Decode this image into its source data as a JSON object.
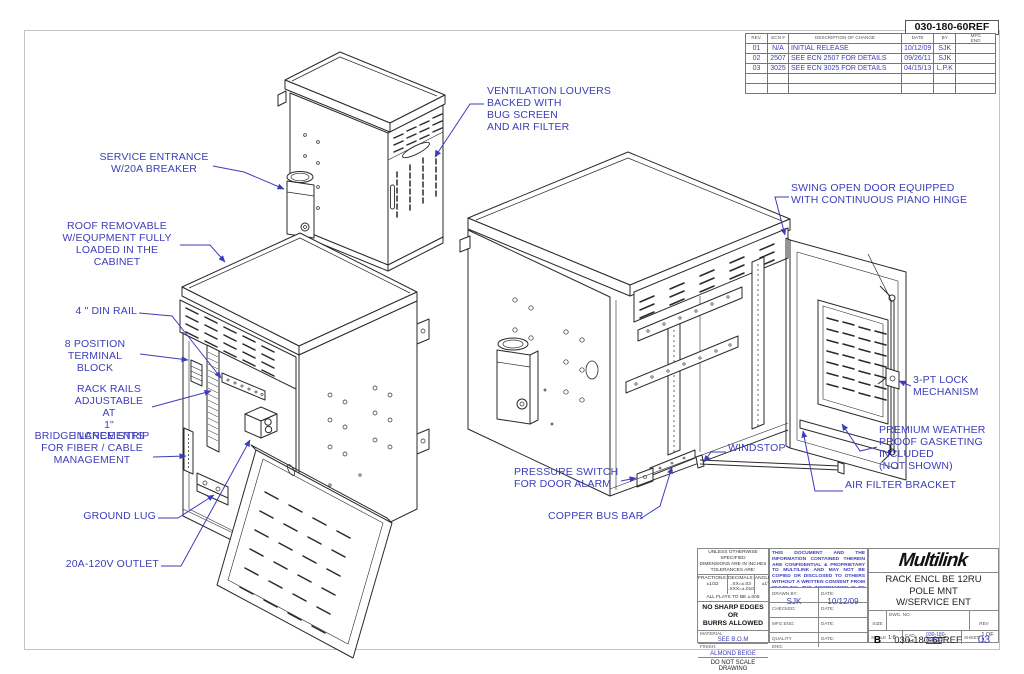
{
  "colors": {
    "callout_blue": "#3d3dba",
    "line_black": "#2a2a2a",
    "border_gray": "#c4c4c4"
  },
  "rev_table": {
    "ref": "030-180-60REF",
    "headers": {
      "rev": "REV.",
      "ecn": "ECN #",
      "desc": "DESCRIPTION OF CHANGE",
      "date": "DATE",
      "by": "BY",
      "mfg": "MFG\nENG"
    },
    "rows": [
      {
        "rev": "01",
        "ecn": "N/A",
        "desc": "INITIAL RELEASE",
        "date": "10/12/09",
        "by": "SJK",
        "mfg": ""
      },
      {
        "rev": "02",
        "ecn": "2507",
        "desc": "SEE ECN 2507 FOR DETAILS",
        "date": "09/26/11",
        "by": "SJK",
        "mfg": ""
      },
      {
        "rev": "03",
        "ecn": "3025",
        "desc": "SEE ECN 3025 FOR DETAILS",
        "date": "04/15/13",
        "by": "L.P.K",
        "mfg": ""
      },
      {
        "rev": "",
        "ecn": "",
        "desc": "",
        "date": "",
        "by": "",
        "mfg": ""
      },
      {
        "rev": "",
        "ecn": "",
        "desc": "",
        "date": "",
        "by": "",
        "mfg": ""
      }
    ]
  },
  "callouts": {
    "service_entrance": "SERVICE ENTRANCE\nW/20A BREAKER",
    "ventilation_louvers": "VENTILATION LOUVERS\nBACKED WITH\nBUG SCREEN\nAND AIR FILTER",
    "roof_removable": "ROOF REMOVABLE\nW/EQUPMENT FULLY\nLOADED IN THE CABINET",
    "din_rail": "4 \" DIN RAIL",
    "terminal_block": "8 POSITION\nTERMINAL BLOCK",
    "rack_rails": "RACK RAILS\nADJUSTABLE AT\n1\" INCREMENTS",
    "bridge_lance": "BRIDGE LANCE STRIP\nFOR FIBER / CABLE\nMANAGEMENT",
    "ground_lug": "GROUND LUG",
    "outlet": "20A-120V OUTLET",
    "swing_door": "SWING OPEN DOOR EQUIPPED\nWITH CONTINUOUS PIANO HINGE",
    "lock": "3-PT LOCK\nMECHANISM",
    "gasketing": "PREMIUM WEATHER\nPROOF GASKETING\nINCLUDED\n(NOT SHOWN)",
    "windstop": "WINDSTOP",
    "air_filter_bracket": "AIR FILTER BRACKET",
    "pressure_switch": "PRESSURE SWITCH\nFOR DOOR ALARM",
    "copper_bus_bar": "COPPER BUS BAR"
  },
  "tolerance_block": {
    "header": "UNLESS OTHERWISE SPECIFIED\nDIMENSIONS ARE IN INCHES\nTOLERANCES ARE:",
    "fractions": "FRACTIONS:\n±1/32",
    "decimals": "DECIMALS:\n.XX=±.03\n.XXX=±.010",
    "angles": "ANGLES:\n±1°",
    "flats": "ALL FLATS TO BE ±.005",
    "warning": "NO SHARP EDGES OR\nBURRS ALLOWED",
    "material_label": "MATERIAL:",
    "material": "SEE B.O.M",
    "finish_label": "FINISH:",
    "finish": "ALMOND BEIGE",
    "do_not_scale": "DO NOT SCALE DRAWING"
  },
  "eng_block": {
    "confidential": "THIS DOCUMENT AND THE INFORMATION CONTAINED THEREIN ARE CONFIDENTIAL & PROPRIETARY TO MULTILINK AND MAY NOT BE COPIED OR DISCLOSED TO OTHERS WITHOUT A WRITTEN CONSENT FROM MULTILINK. THE INFORMATION IS TO BE PROMPTLY RETURNED TO MULTILINK UPON REQUEST",
    "drawn_by_label": "DRAWN BY:",
    "drawn_by": "SJK",
    "date_label": "DATE:",
    "drawn_date": "10/12/09",
    "checked_label": "CHECKED:",
    "mfg_eng_label": "MFG ENG:",
    "quality_label": "QUALITY\nENG:"
  },
  "title_block": {
    "logo": "Multilink",
    "title": "RACK ENCL BE 12RU\nPOLE MNT\nW/SERVICE ENT",
    "size_label": "SIZE",
    "size": "B",
    "dwg_label": "DWG. NO.",
    "dwg_no": "030-180-60REF",
    "rev_label": "REV",
    "rev": "03",
    "scale_label": "SCALE",
    "scale": "1:8",
    "cad_label": "CAD FILE",
    "cad_file": "030-180-60REF",
    "sheet_label": "SHEET",
    "sheet": "1 OF 2"
  }
}
